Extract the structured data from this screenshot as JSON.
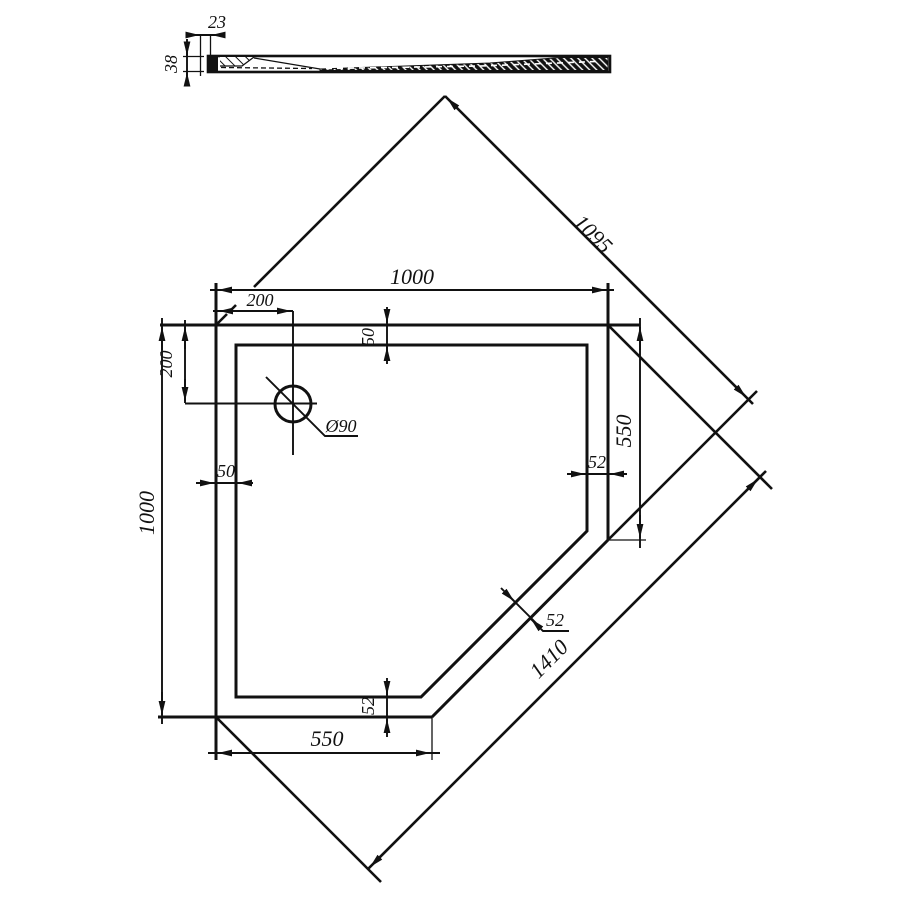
{
  "labels": {
    "profile_lip": "23",
    "profile_height": "38",
    "top_width": "1000",
    "diag_upper": "1095",
    "drain_offset_h": "200",
    "drain_offset_v": "200",
    "wall_top": "50",
    "drain_dia": "Ø90",
    "wall_right": "52",
    "right_edge": "550",
    "wall_left": "50",
    "left_height": "1000",
    "wall_chamfer": "52",
    "diag_lower": "1410",
    "wall_bottom": "52",
    "bottom_edge": "550"
  },
  "colors": {
    "ink": "#111111",
    "background": "#ffffff"
  }
}
